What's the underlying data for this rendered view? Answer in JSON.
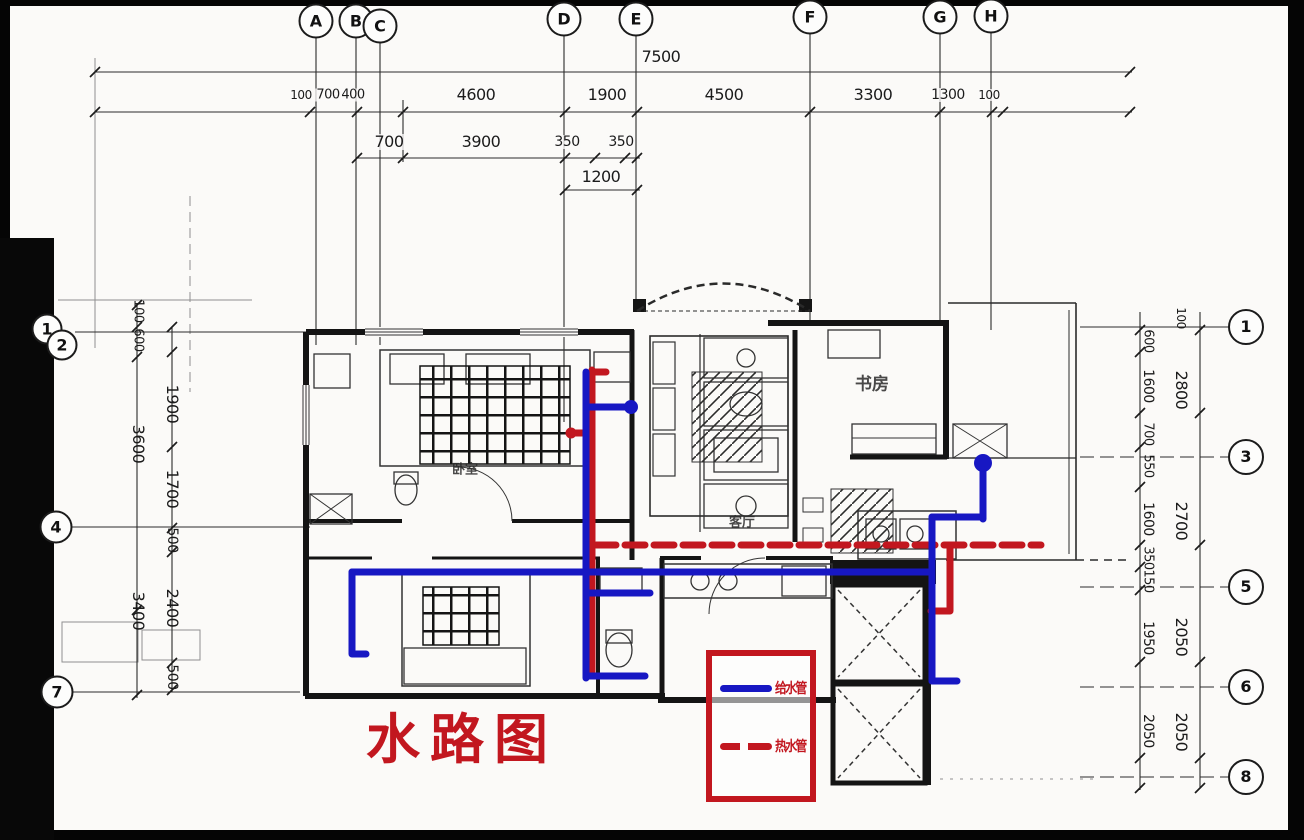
{
  "title": {
    "text": "水路图",
    "color": "#c2171f"
  },
  "legend": {
    "border_color": "#c2171f",
    "items": [
      {
        "label": "给水管",
        "line_color": "#1717c3",
        "style": "solid"
      },
      {
        "label": "热水管",
        "line_color": "#c2171f",
        "style": "dashed"
      }
    ]
  },
  "pipes": {
    "cold_color": "#1717c3",
    "hot_color": "#c2171f"
  },
  "axes": {
    "top": [
      {
        "label": "A",
        "x": 316,
        "y": 21
      },
      {
        "label": "B",
        "x": 356,
        "y": 21
      },
      {
        "label": "C",
        "x": 380,
        "y": 26
      },
      {
        "label": "D",
        "x": 564,
        "y": 19
      },
      {
        "label": "E",
        "x": 636,
        "y": 19
      },
      {
        "label": "F",
        "x": 810,
        "y": 17
      },
      {
        "label": "G",
        "x": 940,
        "y": 17
      },
      {
        "label": "H",
        "x": 991,
        "y": 16
      }
    ],
    "left": [
      {
        "label": "1",
        "x": 47,
        "y": 329,
        "d": 27
      },
      {
        "label": "2",
        "x": 62,
        "y": 345,
        "d": 27
      },
      {
        "label": "4",
        "x": 56,
        "y": 527,
        "d": 29
      },
      {
        "label": "7",
        "x": 57,
        "y": 692,
        "d": 29
      }
    ],
    "right": [
      {
        "label": "1",
        "x": 1246,
        "y": 327
      },
      {
        "label": "3",
        "x": 1246,
        "y": 457
      },
      {
        "label": "5",
        "x": 1246,
        "y": 587
      },
      {
        "label": "6",
        "x": 1246,
        "y": 687
      },
      {
        "label": "8",
        "x": 1246,
        "y": 777
      }
    ]
  },
  "dimensions": {
    "top_row1": [
      {
        "v": "7500",
        "x": 661,
        "y": 57
      }
    ],
    "top_row2": [
      {
        "v": "100",
        "x": 301,
        "s": 12
      },
      {
        "v": "700",
        "x": 328,
        "s": 13
      },
      {
        "v": "400",
        "x": 353,
        "s": 13
      },
      {
        "v": "4600",
        "x": 476
      },
      {
        "v": "1900",
        "x": 607
      },
      {
        "v": "4500",
        "x": 724
      },
      {
        "v": "3300",
        "x": 873
      },
      {
        "v": "1300",
        "x": 948,
        "s": 14
      },
      {
        "v": "100",
        "x": 989,
        "s": 12
      }
    ],
    "top_row3": [
      {
        "v": "700",
        "x": 389
      },
      {
        "v": "3900",
        "x": 481
      },
      {
        "v": "350",
        "x": 567,
        "s": 14
      },
      {
        "v": "350",
        "x": 621,
        "s": 14
      }
    ],
    "top_row4": [
      {
        "v": "1200",
        "x": 601,
        "y": 177
      }
    ],
    "left_outer": [
      {
        "v": "100",
        "y": 311,
        "s": 13
      },
      {
        "v": "600",
        "y": 340,
        "s": 13
      },
      {
        "v": "3600",
        "y": 444
      },
      {
        "v": "3400",
        "y": 611
      }
    ],
    "left_inner": [
      {
        "v": "1900",
        "y": 404
      },
      {
        "v": "1700",
        "y": 489
      },
      {
        "v": "500",
        "y": 540,
        "s": 14
      },
      {
        "v": "2400",
        "y": 608
      },
      {
        "v": "500",
        "y": 677,
        "s": 14
      }
    ],
    "right_inner": [
      {
        "v": "600",
        "y": 341,
        "s": 13
      },
      {
        "v": "1600",
        "y": 386,
        "s": 14
      },
      {
        "v": "700",
        "y": 434,
        "s": 13
      },
      {
        "v": "550",
        "y": 466,
        "s": 13
      },
      {
        "v": "1600",
        "y": 519,
        "s": 14
      },
      {
        "v": "350",
        "y": 558,
        "s": 13
      },
      {
        "v": "150",
        "y": 581,
        "s": 13
      },
      {
        "v": "1950",
        "y": 638,
        "s": 14
      },
      {
        "v": "2050",
        "y": 731,
        "s": 14
      }
    ],
    "right_outer": [
      {
        "v": "100",
        "y": 318,
        "s": 12
      },
      {
        "v": "2800",
        "y": 390
      },
      {
        "v": "2700",
        "y": 521
      },
      {
        "v": "2050",
        "y": 637
      },
      {
        "v": "2050",
        "y": 732
      }
    ]
  },
  "rooms": [
    {
      "label": "书房",
      "x": 872,
      "y": 382,
      "s": 17
    },
    {
      "label": "卧室",
      "x": 465,
      "y": 468,
      "s": 13
    },
    {
      "label": "客厅",
      "x": 742,
      "y": 521,
      "s": 13
    }
  ]
}
